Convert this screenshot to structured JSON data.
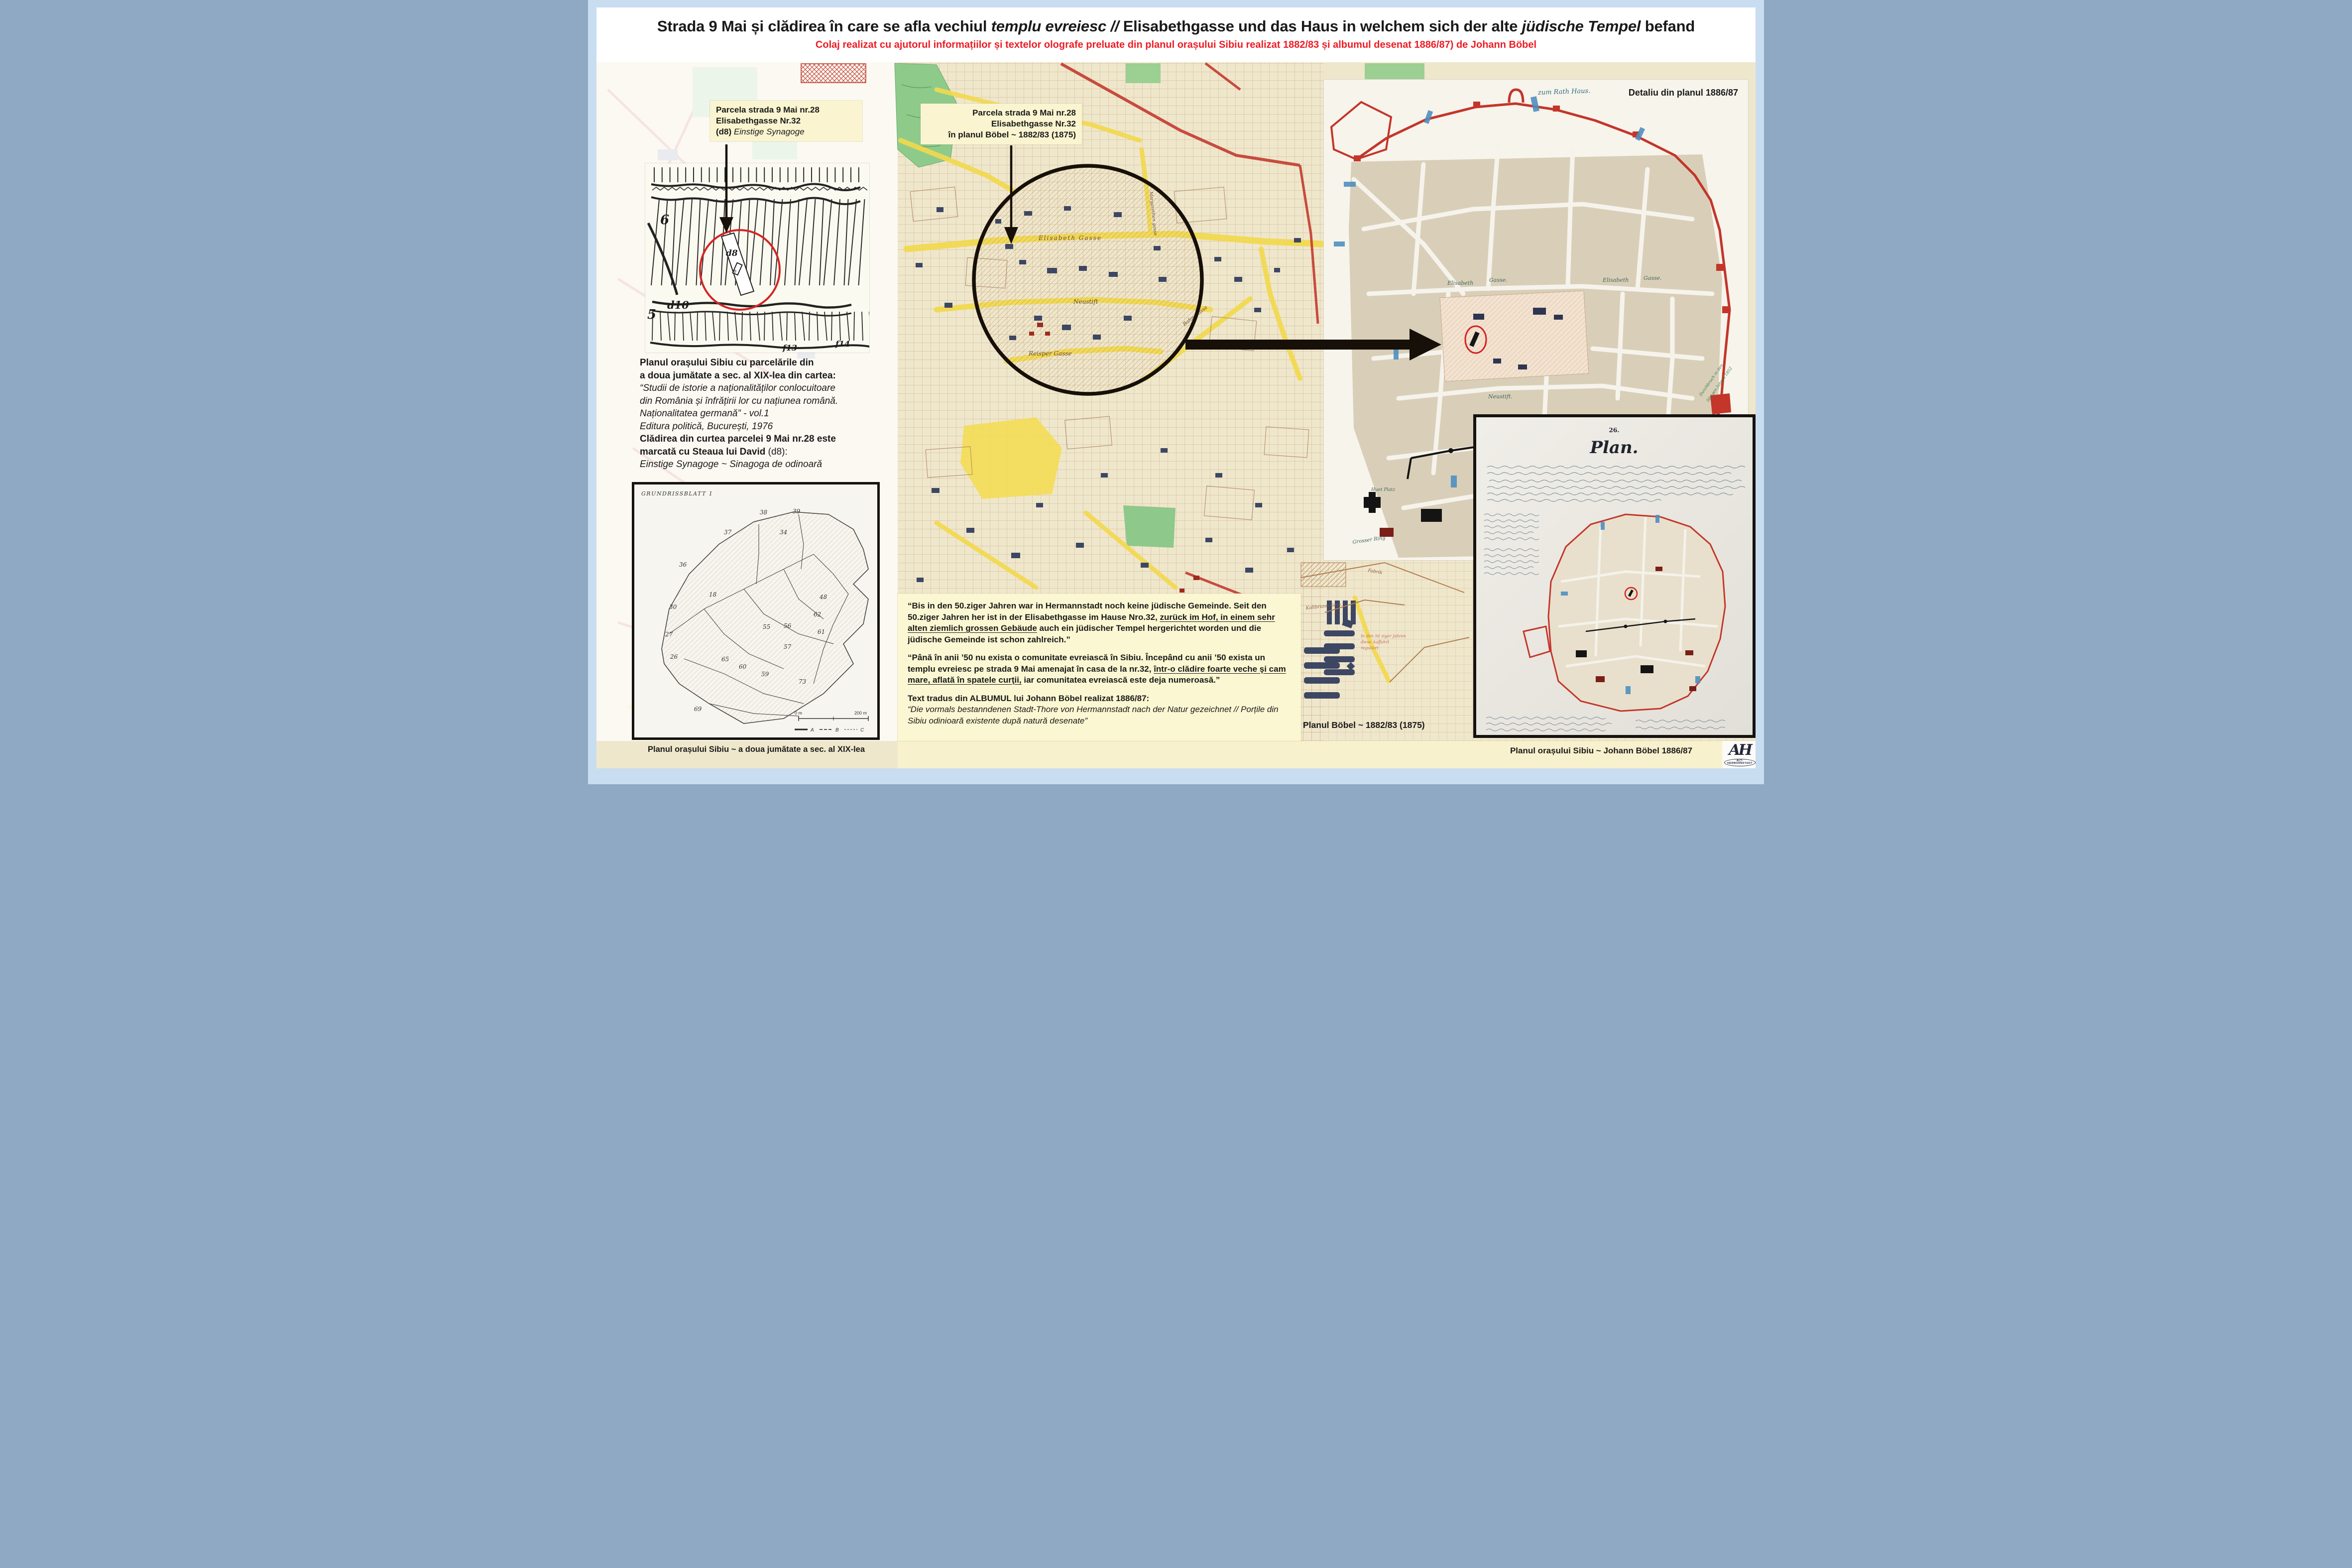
{
  "header": {
    "title": {
      "s1": "Strada 9 Mai și clădirea în care se afla vechiul ",
      "s2": "templu evreiesc",
      "s3": " // ",
      "s4": "Elisabethgasse und das Haus in welchem sich der alte ",
      "s5": "jüdische Tempel",
      "s6": " befand"
    },
    "subtitle": "Colaj realizat cu ajutorul informațiilor și textelor olografe preluate din planul orașului Sibiu realizat 1882/83 și albumul desenat 1886/87) de Johann Böbel"
  },
  "callouts": {
    "left": {
      "l1": "Parcela strada 9 Mai nr.28",
      "l2": "Elisabethgasse Nr.32",
      "l3b": "(d8) ",
      "l3i": "Einstige Synagoge"
    },
    "center": {
      "l1": "Parcela strada 9 Mai nr.28",
      "l2": "Elisabethgasse Nr.32",
      "l3": "în planul Böbel ~ 1882/83 (1875)"
    },
    "detail": "Detaliu din planul 1886/87"
  },
  "left_text": {
    "b1": "Planul orașului Sibiu cu parcelările din",
    "b2": "a doua jumătate a sec. al XIX-lea din cartea:",
    "i1": "“Studii de istorie a naționalităților conlocuitoare",
    "i2": "din România și înfrățirii lor cu națiunea română.",
    "i3": "Naționalitatea germană” - vol.1",
    "i4": "Editura politică, București, 1976",
    "b3": "Clădirea din curtea parcelei 9 Mai nr.28 este",
    "b4": "marcată cu Steaua lui David ",
    "b4n": "(d8):",
    "i5": "Einstige Synagoge ~ Sinagoga de odinoară"
  },
  "quotes": {
    "de": {
      "pre": "“Bis in den 50.ziger Jahren war in Hermannstadt noch keine jüdische Gemeinde. Seit den 50.ziger Jahren her ist in der Elisabethgasse im Hause Nro.32, ",
      "u": "zurück im Hof, in einem sehr alten ziemlich grossen Gebäude",
      "post": " auch ein jüdischer Tempel hergerichtet worden und die jüdische Gemeinde ist schon zahlreich.”"
    },
    "ro": {
      "pre": "“Până în anii ’50 nu exista o comunitate evreiască în Sibiu. Începând cu anii ’50 exista un templu evreiesc pe strada 9 Mai amenajat în casa de la nr.32, ",
      "u": "într-o clădire foarte veche şi cam mare, aflată în spatele curţii,",
      "post": " iar comunitatea evreiască este deja numeroasă.”"
    },
    "album_label": "Text tradus din ALBUMUL lui Johann Böbel realizat 1886/87:",
    "album_quote": "“Die vormals bestanndenen Stadt-Thore von Hermannstadt nach der Natur gezeichnet // Porțile din Sibiu odinioară existente după natură desenate”"
  },
  "captions": {
    "bl": "Planul orașului Sibiu ~ a doua jumătate a sec. al XIX-lea",
    "boebel": "Planul Böbel ~ 1882/83 (1875)",
    "br": "Planul orașului Sibiu ~ Johann Böbel 1886/87"
  },
  "insets": {
    "sketch": {
      "d8": "d8",
      "d10": "d10",
      "n6": "6",
      "n5": "5",
      "f13": "f13",
      "f14": "f14",
      "star": "✡"
    },
    "grundriss": {
      "title": "GRUNDRISSBLATT 1",
      "numbers": [
        "38",
        "39",
        "37",
        "36",
        "34",
        "30",
        "27",
        "26",
        "18",
        "48",
        "55",
        "56",
        "62",
        "61",
        "57",
        "60",
        "65",
        "59",
        "69",
        "73"
      ],
      "scale0": "0 m",
      "scale200": "200 m",
      "la": "A",
      "lb": "B",
      "lc": "C"
    },
    "plan": {
      "no": "26.",
      "title": "Plan."
    }
  },
  "map_labels": {
    "elisabeth": "Elisabeth Gasse",
    "neustift": "Neustift",
    "reisper": "Reisper Gasse",
    "bahn": "Bahn Gasse",
    "margarethen": "Margarethen gasse",
    "fabrik": "Fabrik",
    "kaltbrunn": "Kaltbrunn Gass",
    "noteline1": "In den 50 ziger Jahren",
    "noteline2": "diese Auffahrt",
    "noteline3": "reguliert"
  },
  "panel_labels": {
    "rath": "zum Rath Haus.",
    "e1": "Elisabeth",
    "g1": "Gasse.",
    "e2": "Elisabeth",
    "g2": "Gasse.",
    "neustift": "Neustift.",
    "huet": "Huet Platz",
    "ring": "Grosser Ring",
    "d1": "Durchbruch in den",
    "d2": "50zigen Jahren 1852"
  },
  "logo": {
    "monogram": "AH",
    "text": "ALT-HERMANNSTADT"
  }
}
